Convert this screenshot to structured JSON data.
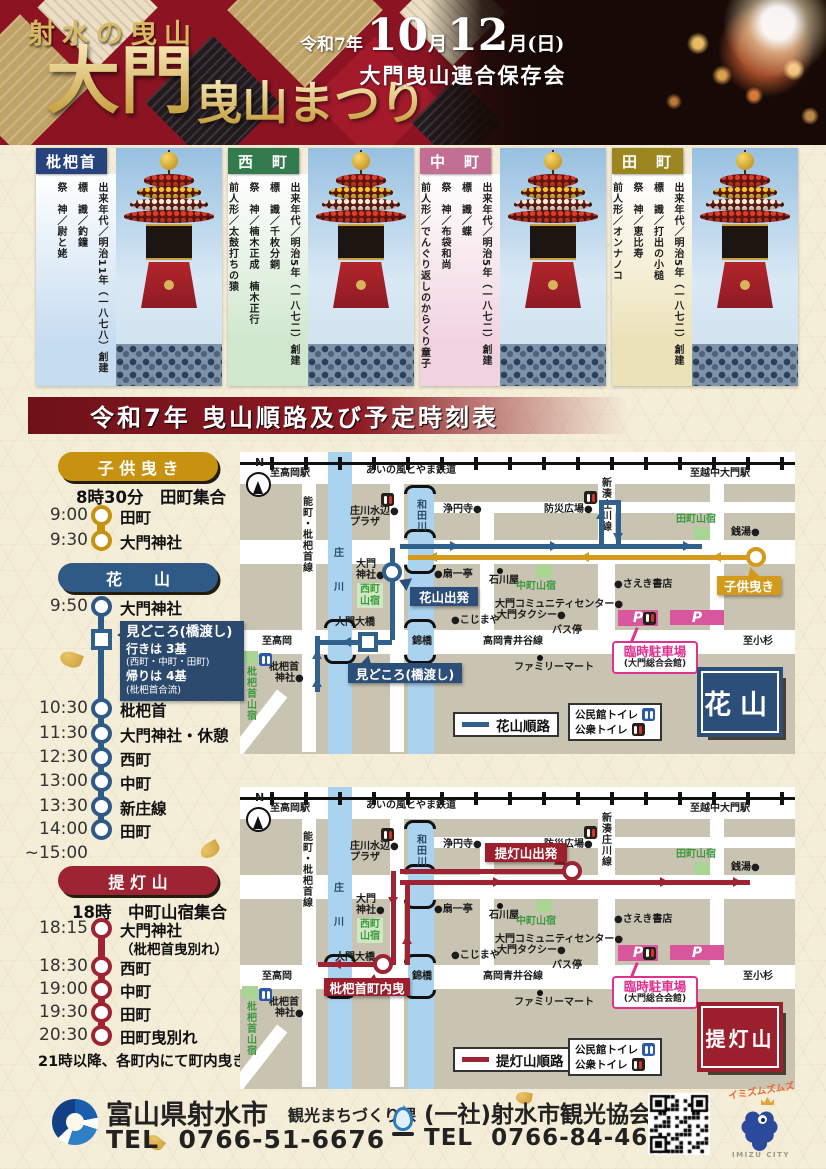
{
  "header": {
    "tagline": "射水の曳山",
    "title_main": "大門",
    "title_sub": "曳山まつり",
    "era": "令和7年",
    "date_parts": [
      "10",
      "月",
      "12",
      "月(日)"
    ],
    "organizer": "大門曳山連合保存会"
  },
  "floats": [
    {
      "name": "枇杷首",
      "color": "#26437e",
      "panel": "#c6dcf0",
      "lines": [
        "出来年代／明治11年（一八七八）創建",
        "標　識／釣鐘",
        "祭　神／尉と姥"
      ]
    },
    {
      "name": "西　町",
      "color": "#337a4d",
      "panel": "#cfe7cd",
      "lines": [
        "出来年代／明治5年（一八七二）創建",
        "標　識／千枚分銅",
        "祭　神／楠木正成　楠木正行",
        "前人形／太鼓打ちの猿"
      ]
    },
    {
      "name": "中　町",
      "color": "#c36f93",
      "panel": "#f1d3df",
      "lines": [
        "出来年代／明治5年（一八七二）創建",
        "標　識／蝶",
        "祭　神／布袋和尚",
        "前人形／でんぐり返しのからくり童子"
      ]
    },
    {
      "name": "田　町",
      "color": "#9c8620",
      "panel": "#ece2b8",
      "lines": [
        "出来年代／明治5年（一八七二）創建",
        "標　識／打出の小槌",
        "祭　神／恵比寿",
        "前人形／オンナノコ"
      ]
    }
  ],
  "schedule_title": "令和7年 曳山順路及び予定時刻表",
  "timelines": [
    {
      "id": "kodomo",
      "label": "子 供 曳 き",
      "color": "#c6920f",
      "meet": "8時30分　田町集合",
      "stops": [
        {
          "time": "9:00",
          "place": "田町"
        },
        {
          "time": "9:30",
          "place": "大門神社"
        }
      ]
    },
    {
      "id": "hanayama",
      "label": "花　　山",
      "color": "#2f5a86",
      "callout": {
        "title": "見どころ(橋渡し)",
        "l1": "行きは 3基",
        "l2": "(西町・中町・田町)",
        "l3": "帰りは 4基",
        "l4": "(枇杷首合流)"
      },
      "stops": [
        {
          "time": "9:50",
          "place": "大門神社"
        },
        {
          "time": "10:30",
          "place": "枇杷首"
        },
        {
          "time": "11:30",
          "place": "大門神社・休憩"
        },
        {
          "time": "12:30",
          "place": "西町"
        },
        {
          "time": "13:00",
          "place": "中町"
        },
        {
          "time": "13:30",
          "place": "新庄線"
        },
        {
          "time": "14:00",
          "place": "田町"
        }
      ],
      "note_after": "~15:00"
    },
    {
      "id": "chochin",
      "label": "提 灯 山",
      "color": "#9e2433",
      "meet": "18時　中町山宿集合",
      "stops": [
        {
          "time": "18:15",
          "place": "大門神社",
          "sub": "（枇杷首曳別れ）"
        },
        {
          "time": "18:30",
          "place": "西町"
        },
        {
          "time": "19:00",
          "place": "中町"
        },
        {
          "time": "19:30",
          "place": "田町"
        },
        {
          "time": "20:30",
          "place": "田町曳別れ"
        }
      ],
      "footnote": "21時以降、各町内にて町内曳き"
    }
  ],
  "map_base": {
    "compass": "N",
    "labels": [
      {
        "t": "至高岡駅",
        "x": 30,
        "y": 16
      },
      {
        "t": "あいの風とやま鉄道",
        "x": 126,
        "y": 13
      },
      {
        "t": "至越中大門駅",
        "x": 450,
        "y": 16
      },
      {
        "t": "能町・枇杷首線",
        "x": 60,
        "y": 44,
        "c": "v"
      },
      {
        "t": "庄",
        "x": 94,
        "y": 96,
        "c": "riv"
      },
      {
        "t": "川",
        "x": 94,
        "y": 130,
        "c": "riv"
      },
      {
        "t": "和田川",
        "x": 174,
        "y": 47,
        "c": "v riv"
      },
      {
        "t": "新湊庄川線",
        "x": 359,
        "y": 25,
        "c": "v"
      },
      {
        "t": "庄川水辺●",
        "x": 110,
        "y": 54
      },
      {
        "t": "プラザ",
        "x": 110,
        "y": 65
      },
      {
        "t": "浄円寺●",
        "x": 203,
        "y": 52
      },
      {
        "t": "防災広場●",
        "x": 304,
        "y": 52
      },
      {
        "t": "田町山宿",
        "x": 436,
        "y": 62,
        "c": "grn"
      },
      {
        "t": "銭湯●",
        "x": 491,
        "y": 75
      },
      {
        "t": "大門",
        "x": 116,
        "y": 107
      },
      {
        "t": "神社●",
        "x": 116,
        "y": 118
      },
      {
        "t": "●扇一亭",
        "x": 194,
        "y": 117
      },
      {
        "t": "石川屋",
        "x": 249,
        "y": 123
      },
      {
        "t": "中町山宿",
        "x": 276,
        "y": 129,
        "c": "grn"
      },
      {
        "t": "●さえき書店",
        "x": 374,
        "y": 127
      },
      {
        "t": "大門コミュニティセンター●",
        "x": 255,
        "y": 147
      },
      {
        "t": "大門タクシー●",
        "x": 257,
        "y": 158
      },
      {
        "t": "●こじまや",
        "x": 211,
        "y": 163
      },
      {
        "t": "バス停",
        "x": 312,
        "y": 173
      },
      {
        "t": "大門大橋",
        "x": 95,
        "y": 165
      },
      {
        "t": "至高岡",
        "x": 22,
        "y": 184
      },
      {
        "t": "錦橋",
        "x": 172,
        "y": 184
      },
      {
        "t": "高岡青井谷線",
        "x": 243,
        "y": 184
      },
      {
        "t": "至小杉",
        "x": 503,
        "y": 184
      },
      {
        "t": "ファミリーマート",
        "x": 274,
        "y": 210
      },
      {
        "t": "枇杷首",
        "x": 29,
        "y": 210
      },
      {
        "t": "神社●",
        "x": 35,
        "y": 221
      },
      {
        "t": "枇杷首山宿",
        "x": 4,
        "y": 214,
        "c": "v grn"
      },
      {
        "t": "西町山宿",
        "x": 117,
        "y": 131,
        "c": "grn chip"
      }
    ],
    "parking": {
      "p": "P",
      "label": "臨時駐車場",
      "sub": "(大門総合会館)"
    },
    "legend_toilet": [
      {
        "t": "公民館トイレ",
        "k": "blue"
      },
      {
        "t": "公衆トイレ",
        "k": "dark"
      }
    ]
  },
  "maps": [
    {
      "id": "hanayama",
      "route_color": "#31608d",
      "kodomo_color": "#d39a1c",
      "start_label": "花山出発",
      "highlight_label": "見どころ(橋渡し)",
      "extra_label": "子供曳き",
      "big_label": "花山",
      "big_color": "#2c4f79",
      "legend_route": "花山順路"
    },
    {
      "id": "chochin",
      "route_color": "#9e2433",
      "start_label": "提灯山出発",
      "extra_label": "枇杷首町内曳",
      "big_label": "提灯山",
      "big_color": "#9b1f2d",
      "legend_route": "提灯山順路"
    }
  ],
  "footer": {
    "org1": "富山県射水市",
    "dept1": "観光まちづくり課",
    "tel_label": "TEL",
    "tel1": "0766-51-6676",
    "org2": "(一社)射水市観光協会",
    "tel2": "0766-84-4649",
    "mascot_top": "イミズムズムズ",
    "mascot_caption": "IMIZU CITY"
  }
}
